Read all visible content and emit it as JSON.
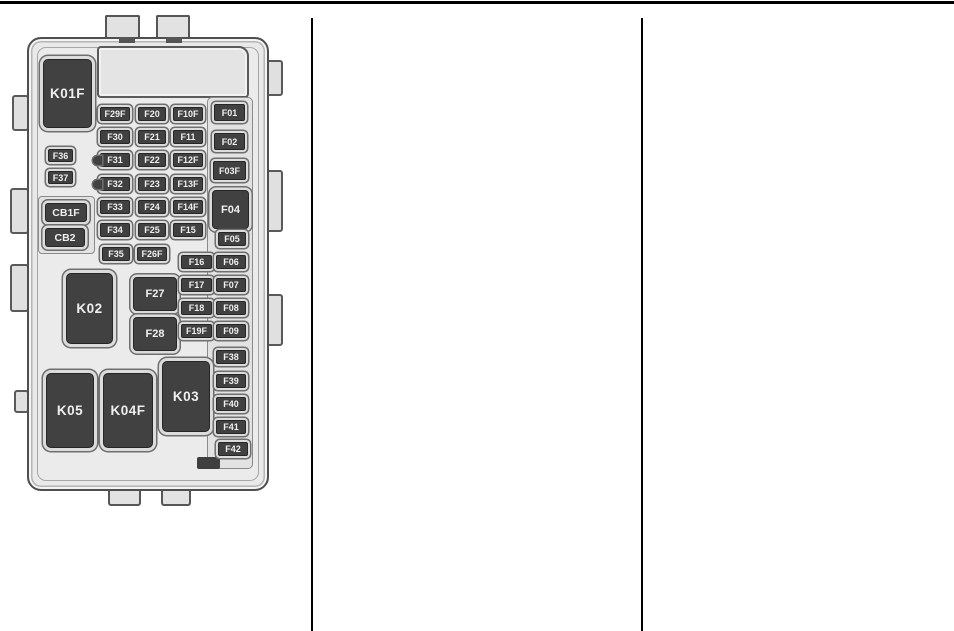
{
  "page": {
    "background": "#ffffff",
    "rule_color": "#000000"
  },
  "figure": {
    "name": "engine-compartment-fuse-block-diagram",
    "colors": {
      "case-fill": "#e9e9e9",
      "case-border": "#4f4f4f",
      "component-fill": "#414141",
      "component-text": "#efefef",
      "frame-light": "#dcdcdc",
      "frame-dark": "#6f6f6f"
    },
    "elements": [
      {
        "label": "K01F",
        "type": "relay",
        "x": 43,
        "y": 59,
        "w": 49,
        "h": 69
      },
      {
        "label": "K02",
        "type": "relay",
        "x": 66,
        "y": 273,
        "w": 47,
        "h": 71
      },
      {
        "label": "K03",
        "type": "relay",
        "x": 162,
        "y": 361,
        "w": 48,
        "h": 71
      },
      {
        "label": "K04F",
        "type": "relay",
        "x": 103,
        "y": 373,
        "w": 50,
        "h": 75
      },
      {
        "label": "K05",
        "type": "relay",
        "x": 46,
        "y": 373,
        "w": 48,
        "h": 75
      },
      {
        "label": "F04",
        "type": "square",
        "x": 212,
        "y": 190,
        "w": 37,
        "h": 39
      },
      {
        "label": "F27",
        "type": "square",
        "x": 133,
        "y": 277,
        "w": 44,
        "h": 34
      },
      {
        "label": "F28",
        "type": "square",
        "x": 133,
        "y": 317,
        "w": 44,
        "h": 34
      },
      {
        "label": "CB1F",
        "type": "breaker",
        "x": 45,
        "y": 203,
        "w": 42,
        "h": 19
      },
      {
        "label": "CB2",
        "type": "breaker",
        "x": 45,
        "y": 228,
        "w": 40,
        "h": 19
      },
      {
        "label": "F36",
        "type": "fuse",
        "x": 48,
        "y": 149,
        "w": 25,
        "h": 13
      },
      {
        "label": "F37",
        "type": "fuse",
        "x": 48,
        "y": 171,
        "w": 25,
        "h": 13
      },
      {
        "label": "F29F",
        "type": "fuse",
        "x": 100,
        "y": 107,
        "w": 30,
        "h": 14
      },
      {
        "label": "F20",
        "type": "fuse",
        "x": 138,
        "y": 107,
        "w": 28,
        "h": 14
      },
      {
        "label": "F10F",
        "type": "fuse",
        "x": 173,
        "y": 107,
        "w": 30,
        "h": 14
      },
      {
        "label": "F30",
        "type": "fuse",
        "x": 100,
        "y": 130,
        "w": 30,
        "h": 14
      },
      {
        "label": "F21",
        "type": "fuse",
        "x": 138,
        "y": 130,
        "w": 28,
        "h": 14
      },
      {
        "label": "F11",
        "type": "fuse",
        "x": 173,
        "y": 130,
        "w": 30,
        "h": 14
      },
      {
        "label": "F31",
        "type": "fuse",
        "x": 100,
        "y": 153,
        "w": 30,
        "h": 14,
        "variant": "tab-left"
      },
      {
        "label": "F22",
        "type": "fuse",
        "x": 138,
        "y": 153,
        "w": 28,
        "h": 14
      },
      {
        "label": "F12F",
        "type": "fuse",
        "x": 173,
        "y": 153,
        "w": 30,
        "h": 14
      },
      {
        "label": "F32",
        "type": "fuse",
        "x": 100,
        "y": 177,
        "w": 30,
        "h": 14,
        "variant": "tab-left"
      },
      {
        "label": "F23",
        "type": "fuse",
        "x": 138,
        "y": 177,
        "w": 28,
        "h": 14
      },
      {
        "label": "F13F",
        "type": "fuse",
        "x": 173,
        "y": 177,
        "w": 30,
        "h": 14
      },
      {
        "label": "F33",
        "type": "fuse",
        "x": 100,
        "y": 200,
        "w": 30,
        "h": 14
      },
      {
        "label": "F24",
        "type": "fuse",
        "x": 138,
        "y": 200,
        "w": 28,
        "h": 14
      },
      {
        "label": "F14F",
        "type": "fuse",
        "x": 173,
        "y": 200,
        "w": 30,
        "h": 14
      },
      {
        "label": "F34",
        "type": "fuse",
        "x": 100,
        "y": 223,
        "w": 30,
        "h": 14
      },
      {
        "label": "F25",
        "type": "fuse",
        "x": 138,
        "y": 223,
        "w": 28,
        "h": 14
      },
      {
        "label": "F15",
        "type": "fuse",
        "x": 173,
        "y": 223,
        "w": 30,
        "h": 14
      },
      {
        "label": "F35",
        "type": "fuse",
        "x": 102,
        "y": 247,
        "w": 28,
        "h": 14
      },
      {
        "label": "F26F",
        "type": "fuse",
        "x": 137,
        "y": 247,
        "w": 30,
        "h": 14
      },
      {
        "label": "F01",
        "type": "fuse",
        "x": 214,
        "y": 104,
        "w": 31,
        "h": 17
      },
      {
        "label": "F02",
        "type": "fuse",
        "x": 214,
        "y": 133,
        "w": 31,
        "h": 17
      },
      {
        "label": "F03F",
        "type": "fuse",
        "x": 213,
        "y": 161,
        "w": 33,
        "h": 19
      },
      {
        "label": "F05",
        "type": "fuse",
        "x": 218,
        "y": 232,
        "w": 28,
        "h": 14
      },
      {
        "label": "F16",
        "type": "fuse",
        "x": 181,
        "y": 255,
        "w": 31,
        "h": 14
      },
      {
        "label": "F06",
        "type": "fuse",
        "x": 216,
        "y": 255,
        "w": 30,
        "h": 14
      },
      {
        "label": "F17",
        "type": "fuse",
        "x": 181,
        "y": 278,
        "w": 31,
        "h": 14
      },
      {
        "label": "F07",
        "type": "fuse",
        "x": 216,
        "y": 278,
        "w": 30,
        "h": 14
      },
      {
        "label": "F18",
        "type": "fuse",
        "x": 181,
        "y": 301,
        "w": 31,
        "h": 14
      },
      {
        "label": "F08",
        "type": "fuse",
        "x": 216,
        "y": 301,
        "w": 30,
        "h": 14
      },
      {
        "label": "F19F",
        "type": "fuse",
        "x": 181,
        "y": 324,
        "w": 31,
        "h": 14
      },
      {
        "label": "F09",
        "type": "fuse",
        "x": 216,
        "y": 324,
        "w": 30,
        "h": 14
      },
      {
        "label": "F38",
        "type": "fuse",
        "x": 216,
        "y": 350,
        "w": 30,
        "h": 14
      },
      {
        "label": "F39",
        "type": "fuse",
        "x": 216,
        "y": 374,
        "w": 30,
        "h": 14
      },
      {
        "label": "F40",
        "type": "fuse",
        "x": 216,
        "y": 397,
        "w": 30,
        "h": 14
      },
      {
        "label": "F41",
        "type": "fuse",
        "x": 216,
        "y": 420,
        "w": 30,
        "h": 14
      },
      {
        "label": "F42",
        "type": "fuse",
        "x": 218,
        "y": 442,
        "w": 30,
        "h": 14
      }
    ]
  }
}
